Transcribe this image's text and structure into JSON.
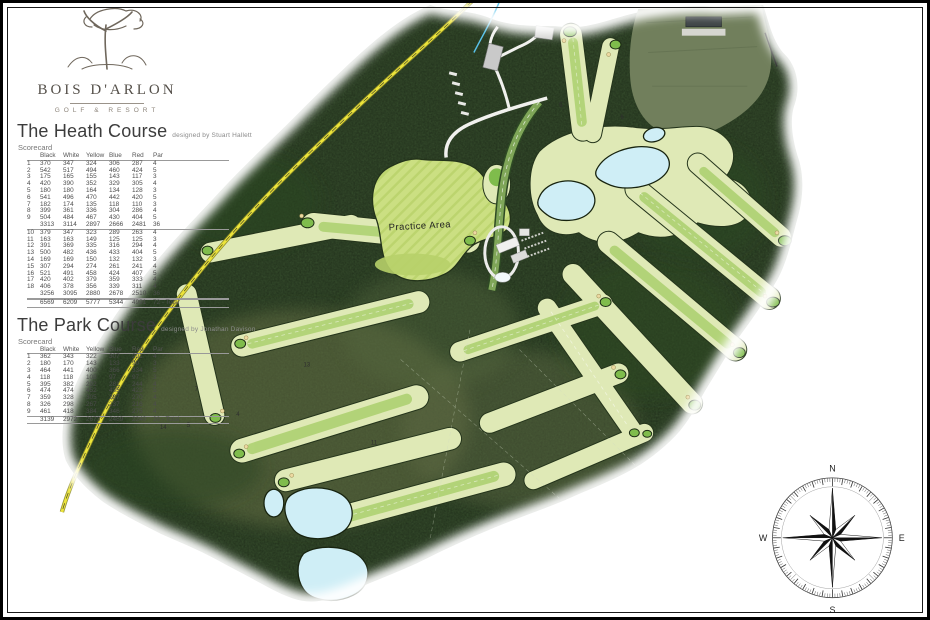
{
  "brand": {
    "name": "BOIS D'ARLON",
    "tagline": "GOLF & RESORT"
  },
  "heath_course": {
    "title": "The Heath Course",
    "designer": "designed by Stuart Hallett",
    "scorecard_label": "Scorecard",
    "columns": [
      "",
      "Black",
      "White",
      "Yellow",
      "Blue",
      "Red",
      "Par"
    ],
    "rows": [
      {
        "c": [
          "1",
          "370",
          "347",
          "324",
          "306",
          "287",
          "4"
        ]
      },
      {
        "c": [
          "2",
          "542",
          "517",
          "494",
          "460",
          "424",
          "5"
        ]
      },
      {
        "c": [
          "3",
          "175",
          "165",
          "155",
          "143",
          "117",
          "3"
        ]
      },
      {
        "c": [
          "4",
          "420",
          "390",
          "352",
          "329",
          "305",
          "4"
        ]
      },
      {
        "c": [
          "5",
          "180",
          "180",
          "164",
          "134",
          "128",
          "3"
        ]
      },
      {
        "c": [
          "6",
          "541",
          "496",
          "470",
          "442",
          "420",
          "5"
        ]
      },
      {
        "c": [
          "7",
          "182",
          "174",
          "135",
          "118",
          "110",
          "3"
        ]
      },
      {
        "c": [
          "8",
          "399",
          "361",
          "336",
          "304",
          "286",
          "4"
        ]
      },
      {
        "c": [
          "9",
          "504",
          "484",
          "467",
          "430",
          "404",
          "5"
        ]
      },
      {
        "c": [
          "",
          "3313",
          "3114",
          "2897",
          "2666",
          "2481",
          "36"
        ],
        "t": true
      },
      {
        "c": [
          "10",
          "379",
          "347",
          "323",
          "289",
          "263",
          "4"
        ]
      },
      {
        "c": [
          "11",
          "163",
          "163",
          "149",
          "125",
          "125",
          "3"
        ]
      },
      {
        "c": [
          "12",
          "391",
          "369",
          "335",
          "316",
          "294",
          "4"
        ]
      },
      {
        "c": [
          "13",
          "500",
          "482",
          "436",
          "433",
          "404",
          "5"
        ]
      },
      {
        "c": [
          "14",
          "169",
          "169",
          "150",
          "132",
          "132",
          "3"
        ]
      },
      {
        "c": [
          "15",
          "307",
          "294",
          "274",
          "261",
          "241",
          "4"
        ]
      },
      {
        "c": [
          "16",
          "521",
          "491",
          "458",
          "424",
          "407",
          "5"
        ]
      },
      {
        "c": [
          "17",
          "420",
          "402",
          "379",
          "359",
          "333",
          "4"
        ]
      },
      {
        "c": [
          "18",
          "406",
          "378",
          "356",
          "339",
          "311",
          "4"
        ]
      },
      {
        "c": [
          "",
          "3256",
          "3095",
          "2880",
          "2678",
          "2510",
          "36"
        ],
        "t": true
      },
      {
        "c": [
          "",
          "6569",
          "6209",
          "5777",
          "5344",
          "4991",
          "72 - Total"
        ],
        "g": true
      }
    ]
  },
  "park_course": {
    "title": "The Park Course",
    "designer": "designed by Jonathan Davison",
    "scorecard_label": "Scorecard",
    "columns": [
      "",
      "Black",
      "White",
      "Yellow",
      "Blue",
      "Red",
      "Par"
    ],
    "rows": [
      {
        "c": [
          "1",
          "362",
          "343",
          "322",
          "307",
          "291",
          "4"
        ]
      },
      {
        "c": [
          "2",
          "180",
          "170",
          "143",
          "133",
          "90",
          "3"
        ]
      },
      {
        "c": [
          "3",
          "464",
          "441",
          "400",
          "366",
          "334",
          "5"
        ]
      },
      {
        "c": [
          "4",
          "118",
          "118",
          "108",
          "97",
          "97",
          "3"
        ]
      },
      {
        "c": [
          "5",
          "395",
          "382",
          "292",
          "281",
          "244",
          "4"
        ]
      },
      {
        "c": [
          "6",
          "474",
          "474",
          "452",
          "435",
          "423",
          "5"
        ]
      },
      {
        "c": [
          "7",
          "359",
          "328",
          "305",
          "287",
          "270",
          "4"
        ]
      },
      {
        "c": [
          "8",
          "326",
          "298",
          "267",
          "237",
          "216",
          "4"
        ]
      },
      {
        "c": [
          "9",
          "461",
          "418",
          "384",
          "346",
          "275",
          "4"
        ]
      },
      {
        "c": [
          "",
          "3139",
          "2972",
          "2673",
          "2489",
          "2240",
          "36 - Total"
        ],
        "g": true
      }
    ]
  },
  "map": {
    "practice_area_label": "Practice Area",
    "hole_labels": [
      "5",
      "6",
      "13",
      "4",
      "5",
      "14",
      "11",
      "7"
    ],
    "colors": {
      "forest": "#3a5330",
      "fairway": "#dfe9b6",
      "practice": "#cbdf82",
      "green": "#7fbc4c",
      "lake": "#cfeef6",
      "sand": "#ecd9a2",
      "road_yellow": "#ece43a"
    }
  },
  "compass": {
    "n": "N",
    "e": "E",
    "s": "S",
    "w": "W"
  }
}
